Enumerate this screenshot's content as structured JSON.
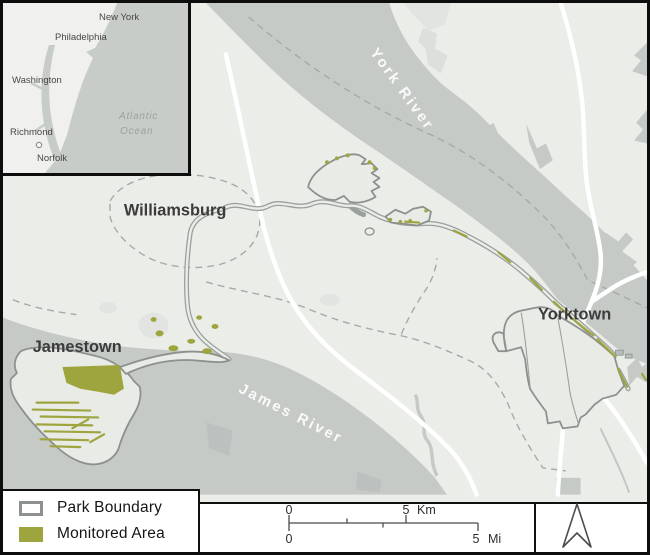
{
  "inset": {
    "cities": {
      "new_york": "New York",
      "philadelphia": "Philadelphia",
      "washington": "Washington",
      "richmond": "Richmond",
      "norfolk": "Norfolk"
    },
    "ocean_line1": "Atlantic",
    "ocean_line2": "Ocean",
    "park_marker": "circle"
  },
  "map": {
    "places": {
      "williamsburg": "Williamsburg",
      "jamestown": "Jamestown",
      "yorktown": "Yorktown"
    },
    "rivers": {
      "york": "York River",
      "james": "James River"
    }
  },
  "legend": {
    "park_boundary": "Park Boundary",
    "monitored_area": "Monitored Area"
  },
  "scalebar": {
    "zero": "0",
    "five": "5",
    "km_unit": "Km",
    "mi_unit": "Mi"
  },
  "colors": {
    "monitored": "#9fa53e",
    "water": "#c6cac7",
    "land": "#ebede9",
    "park_fill": "#e9ebe6",
    "boundary_stroke": "#8c918d",
    "frame_border": "#0d0d0d"
  }
}
